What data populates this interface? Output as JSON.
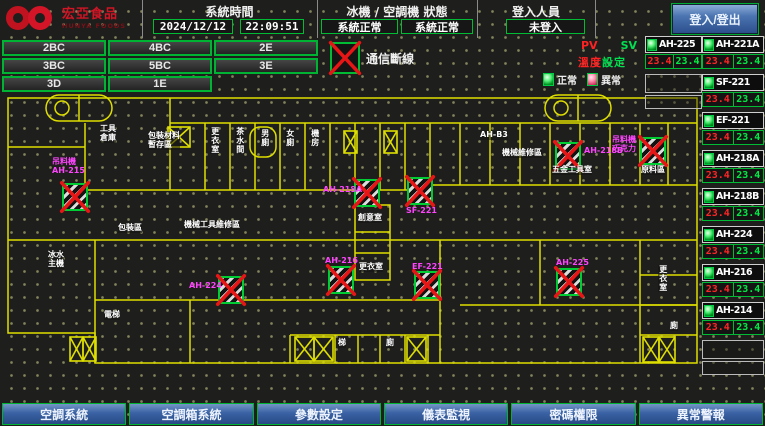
{
  "header": {
    "logo": {
      "title": "宏亞食品",
      "subtitle": "HUNYA FOODS"
    },
    "system_time": {
      "title": "系統時間",
      "date": "2024/12/12",
      "time": "22:09:51"
    },
    "status": {
      "title": "冰機 / 空調機 狀態",
      "chiller": "系統正常",
      "ahu": "系統正常"
    },
    "login": {
      "title": "登入人員",
      "value": "未登入",
      "button": "登入/登出"
    }
  },
  "floor_buttons": [
    "2BC",
    "4BC",
    "2E",
    "3BC",
    "5BC",
    "3E",
    "3D",
    "1E"
  ],
  "comm_legend": "通信斷線",
  "value_headers": {
    "pv": "PV",
    "sv": "SV",
    "set_left": "溫度",
    "set_right": "設定"
  },
  "status_legend": {
    "normal": "正常",
    "abnormal": "異常"
  },
  "equipment": {
    "left": [
      {
        "name": "AH-225",
        "pv": "23.4",
        "sv": "23.4"
      }
    ],
    "right": [
      {
        "name": "AH-221A",
        "pv": "23.4",
        "sv": "23.4"
      },
      {
        "name": "SF-221",
        "pv": "23.4",
        "sv": "23.4"
      },
      {
        "name": "EF-221",
        "pv": "23.4",
        "sv": "23.4"
      },
      {
        "name": "AH-218A",
        "pv": "23.4",
        "sv": "23.4"
      },
      {
        "name": "AH-218B",
        "pv": "23.4",
        "sv": "23.4"
      },
      {
        "name": "AH-224",
        "pv": "23.4",
        "sv": "23.4"
      },
      {
        "name": "AH-216",
        "pv": "23.4",
        "sv": "23.4"
      },
      {
        "name": "AH-214",
        "pv": "23.4",
        "sv": "23.4"
      }
    ]
  },
  "map": {
    "units": [
      {
        "x": 62,
        "y": 96
      },
      {
        "x": 218,
        "y": 189
      },
      {
        "x": 328,
        "y": 179
      },
      {
        "x": 354,
        "y": 92
      },
      {
        "x": 407,
        "y": 90
      },
      {
        "x": 414,
        "y": 184
      },
      {
        "x": 556,
        "y": 181
      },
      {
        "x": 555,
        "y": 55
      },
      {
        "x": 640,
        "y": 50
      }
    ],
    "unit_labels": [
      {
        "text": "吊料機\nAH-215",
        "x": 52,
        "y": 70
      },
      {
        "text": "AH-224",
        "x": 189,
        "y": 194
      },
      {
        "text": "AH-216",
        "x": 325,
        "y": 169
      },
      {
        "text": "AH-218A",
        "x": 323,
        "y": 98
      },
      {
        "text": "SF-221",
        "x": 406,
        "y": 119
      },
      {
        "text": "EF-221",
        "x": 412,
        "y": 175
      },
      {
        "text": "AH-225",
        "x": 556,
        "y": 171
      },
      {
        "text": "AH-218B",
        "x": 584,
        "y": 59
      },
      {
        "text": "吊料機\n巧克力",
        "x": 612,
        "y": 48
      }
    ],
    "room_labels": [
      {
        "text": "工具\n倉庫",
        "x": 100,
        "y": 38
      },
      {
        "text": "包裝材料\n暫存區",
        "x": 148,
        "y": 45
      },
      {
        "text": "更衣室",
        "x": 210,
        "y": 40,
        "cls": "vert"
      },
      {
        "text": "茶水間",
        "x": 235,
        "y": 40,
        "cls": "vert"
      },
      {
        "text": "男廁",
        "x": 260,
        "y": 42,
        "cls": "vert"
      },
      {
        "text": "女廁",
        "x": 285,
        "y": 42,
        "cls": "vert"
      },
      {
        "text": "機房",
        "x": 310,
        "y": 42,
        "cls": "vert"
      },
      {
        "text": "AH-B3",
        "x": 480,
        "y": 44
      },
      {
        "text": "機械維修區",
        "x": 502,
        "y": 62
      },
      {
        "text": "五金工具室",
        "x": 552,
        "y": 79
      },
      {
        "text": "原料區",
        "x": 641,
        "y": 79
      },
      {
        "text": "包裝區",
        "x": 118,
        "y": 137
      },
      {
        "text": "機械工具維修區",
        "x": 184,
        "y": 134
      },
      {
        "text": "創意室",
        "x": 358,
        "y": 127
      },
      {
        "text": "更衣室",
        "x": 359,
        "y": 176
      },
      {
        "text": "冰水\n主機",
        "x": 48,
        "y": 164
      },
      {
        "text": "電梯",
        "x": 104,
        "y": 224
      },
      {
        "text": "梯",
        "x": 338,
        "y": 252
      },
      {
        "text": "廁",
        "x": 386,
        "y": 252
      },
      {
        "text": "更衣室",
        "x": 658,
        "y": 178,
        "cls": "vert"
      },
      {
        "text": "廁",
        "x": 670,
        "y": 235
      }
    ]
  },
  "bottom_buttons": [
    "空調系統",
    "空調箱系統",
    "參數設定",
    "儀表監視",
    "密碼權限",
    "異常警報"
  ],
  "colors": {
    "accent_green": "#00bb33",
    "alarm_red": "#ff2222",
    "sv_green": "#00e050",
    "magenta": "#ff44ff",
    "wall_yellow": "#dede00",
    "button_blue": "#3a62a4"
  }
}
